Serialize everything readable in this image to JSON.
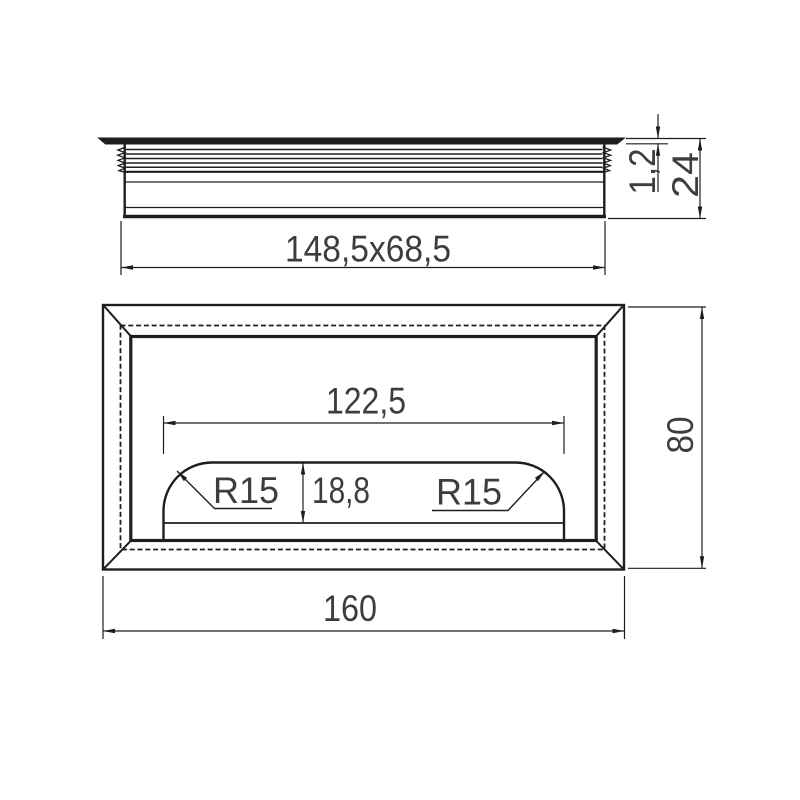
{
  "drawing": {
    "background": "#ffffff",
    "line_color": "#1e1e1e",
    "text_color": "#3d3d3d",
    "side_view": {
      "cutout_size_label": "148,5x68,5",
      "flange_thickness_label": "1,2",
      "total_height_label": "24"
    },
    "plan_view": {
      "inner_width_label": "122,5",
      "inner_height_label": "18,8",
      "radius_left_label": "R15",
      "radius_right_label": "R15",
      "overall_height_label": "80",
      "overall_width_label": "160"
    }
  }
}
